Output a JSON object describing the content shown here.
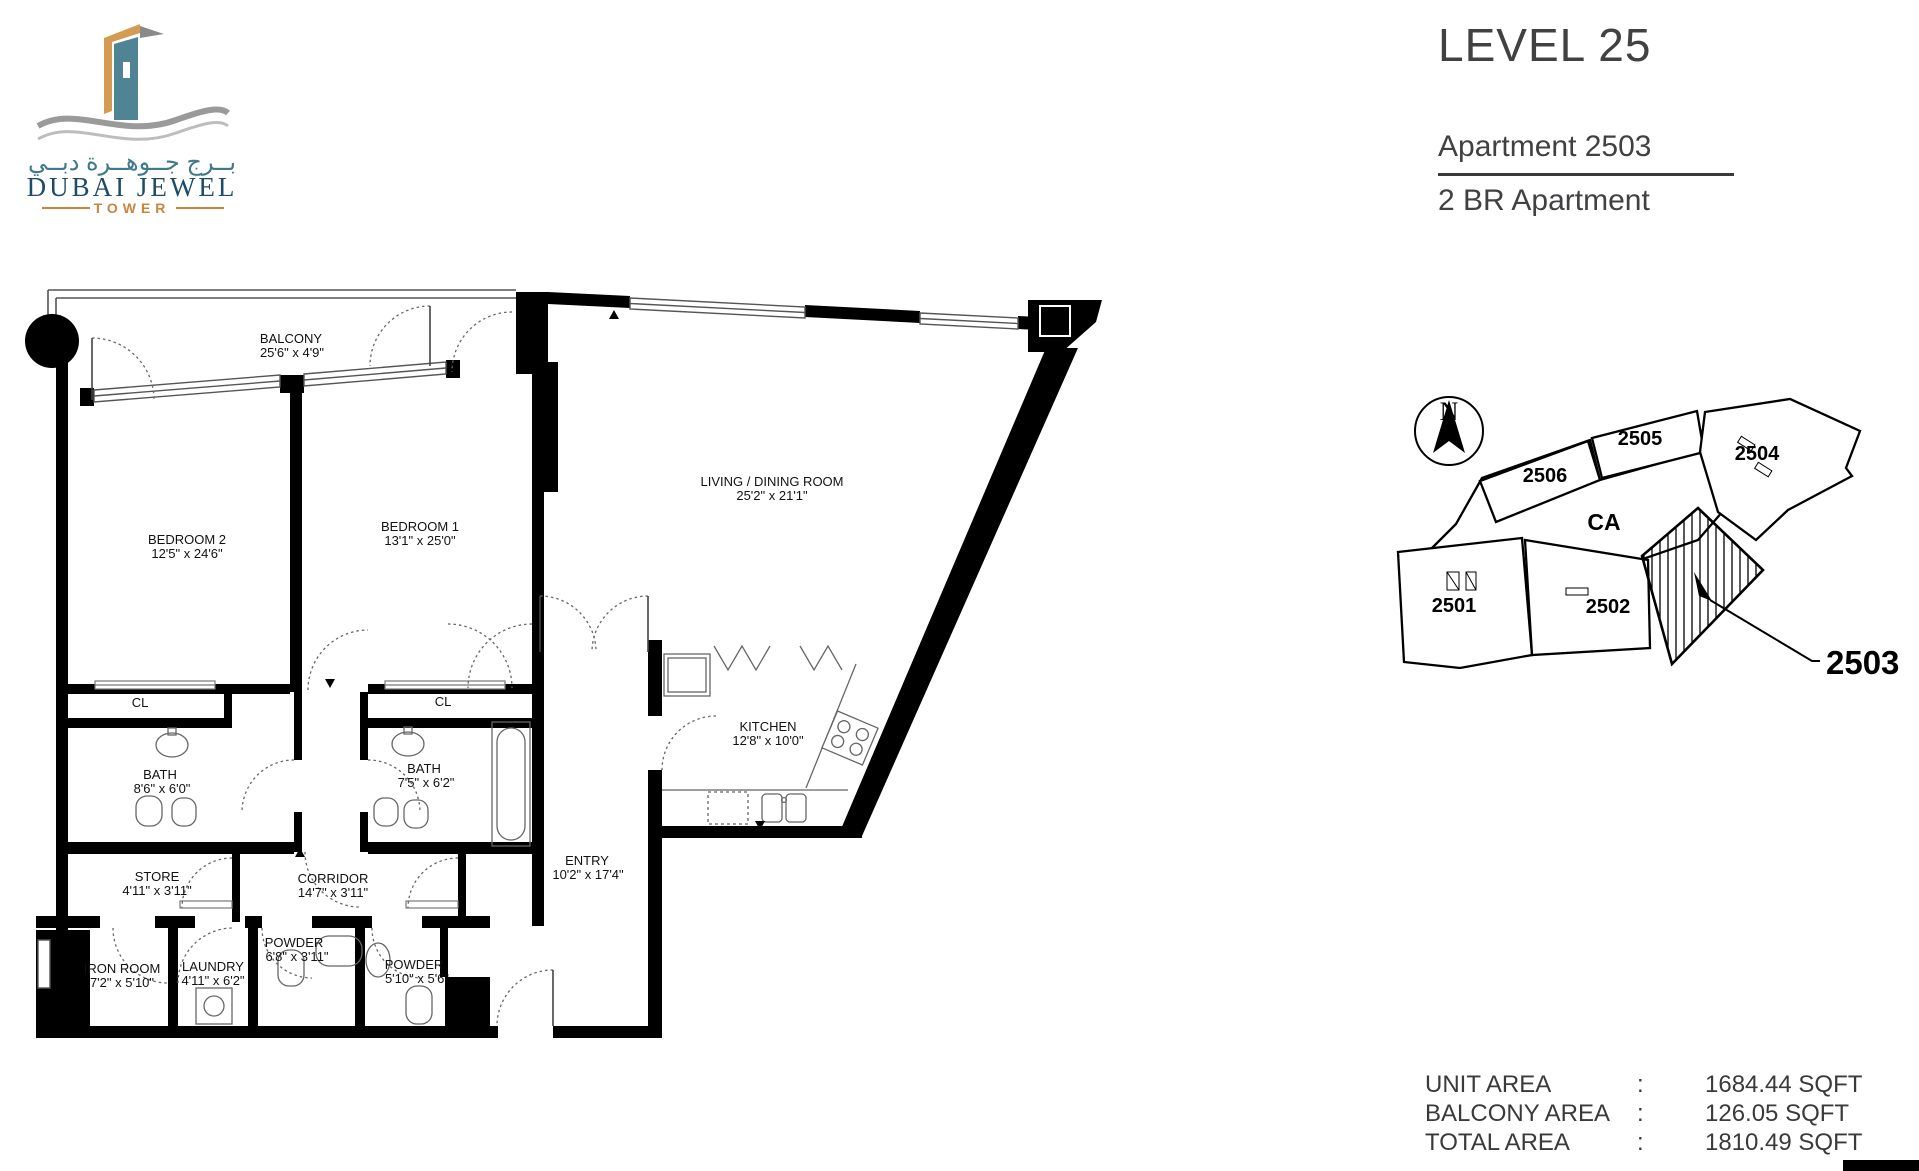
{
  "logo": {
    "arabic_name": "بــرج جــوهــرة دبــي",
    "name": "DUBAI JEWEL",
    "subtitle": "TOWER"
  },
  "header": {
    "level_title": "LEVEL 25",
    "apartment_label": "Apartment 2503",
    "apartment_type": "2 BR Apartment"
  },
  "floor_plan": {
    "rooms": [
      {
        "name": "BALCONY",
        "dims": "25'6\" x 4'9\""
      },
      {
        "name": "BEDROOM 2",
        "dims": "12'5\" x 24'6\""
      },
      {
        "name": "BEDROOM 1",
        "dims": "13'1\" x 25'0\""
      },
      {
        "name": "LIVING / DINING ROOM",
        "dims": "25'2\" x 21'1\""
      },
      {
        "name": "KITCHEN",
        "dims": "12'8\" x 10'0\""
      },
      {
        "name": "CL",
        "dims": ""
      },
      {
        "name": "CL",
        "dims": ""
      },
      {
        "name": "BATH",
        "dims": "8'6\" x 6'0\""
      },
      {
        "name": "BATH",
        "dims": "7'5\" x 6'2\""
      },
      {
        "name": "STORE",
        "dims": "4'11\" x 3'11\""
      },
      {
        "name": "CORRIDOR",
        "dims": "14'7\" x 3'11\""
      },
      {
        "name": "ENTRY",
        "dims": "10'2\" x 17'4\""
      },
      {
        "name": "IRON ROOM",
        "dims": "7'2\" x 5'10\""
      },
      {
        "name": "LAUNDRY",
        "dims": "4'11\" x 6'2\""
      },
      {
        "name": "POWDER",
        "dims": "6'8\" x 3'11\""
      },
      {
        "name": "POWDER",
        "dims": "5'10\" x 5'6\""
      }
    ]
  },
  "key_plan": {
    "north_label": "N",
    "common_area_label": "CA",
    "callout_label": "2503",
    "units": [
      "2501",
      "2502",
      "2504",
      "2505",
      "2506"
    ]
  },
  "areas": {
    "rows": [
      {
        "label": "UNIT AREA",
        "colon": ":",
        "value": "1684.44 SQFT"
      },
      {
        "label": "BALCONY AREA",
        "colon": ":",
        "value": "126.05 SQFT"
      },
      {
        "label": "TOTAL AREA",
        "colon": ":",
        "value": "1810.49 SQFT"
      }
    ]
  },
  "colors": {
    "logo_teal": "#4e8494",
    "logo_orange": "#d49c52",
    "logo_navy": "#1d4c68",
    "accent_orange": "#c8863c",
    "text_dark": "#3f4040",
    "plan_black": "#000000"
  }
}
